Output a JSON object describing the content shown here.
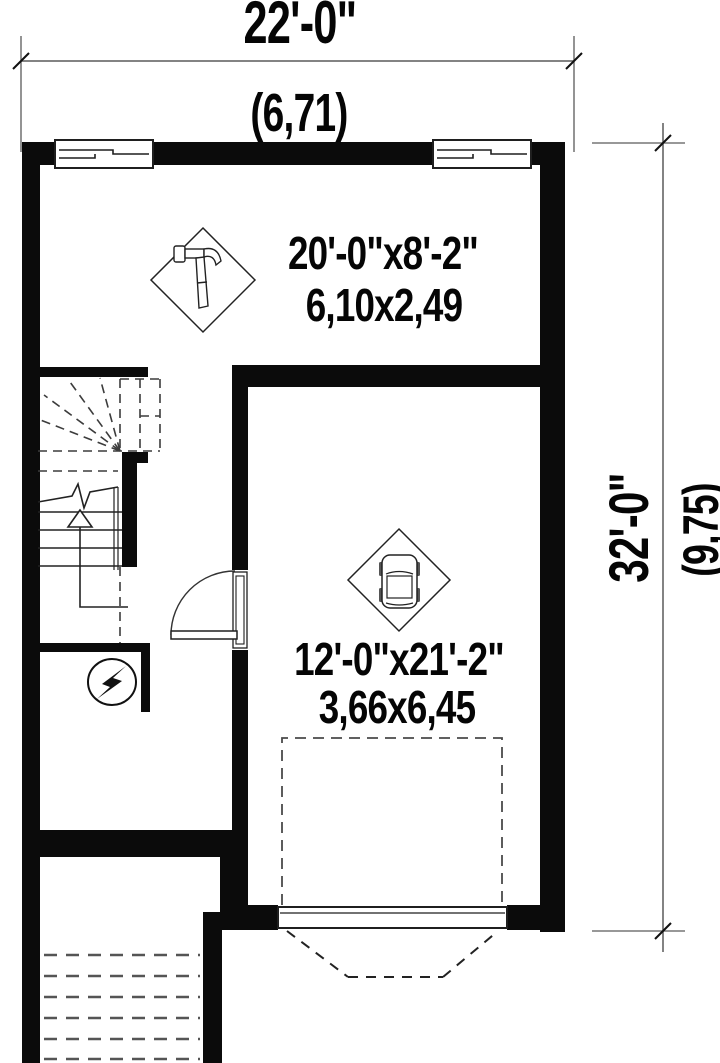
{
  "plan": {
    "type": "basement-garage floor plan",
    "dimensions": {
      "top": {
        "imperial": "22'-0\"",
        "metric": "(6,71)"
      },
      "right": {
        "imperial": "32'-0\"",
        "metric": "(9,75)"
      }
    },
    "rooms": {
      "workshop": {
        "imperial": "20'-0\"x8'-2\"",
        "metric": "6,10x2,49",
        "icon": "hammer-icon"
      },
      "garage": {
        "imperial": "12'-0\"x21'-2\"",
        "metric": "3,66x6,45",
        "icon": "car-icon"
      }
    },
    "symbols": [
      "hammer-icon",
      "car-icon",
      "electrical-panel-icon",
      "stairs-up-arrow",
      "door-swing",
      "garage-door",
      "windows",
      "exterior-steps"
    ],
    "colors": {
      "wall": "#0b0b0b",
      "line": "#1f1f1f",
      "dash": "#4a4a4a",
      "dim_line": "#5a5a5a",
      "background": "#ffffff"
    }
  }
}
